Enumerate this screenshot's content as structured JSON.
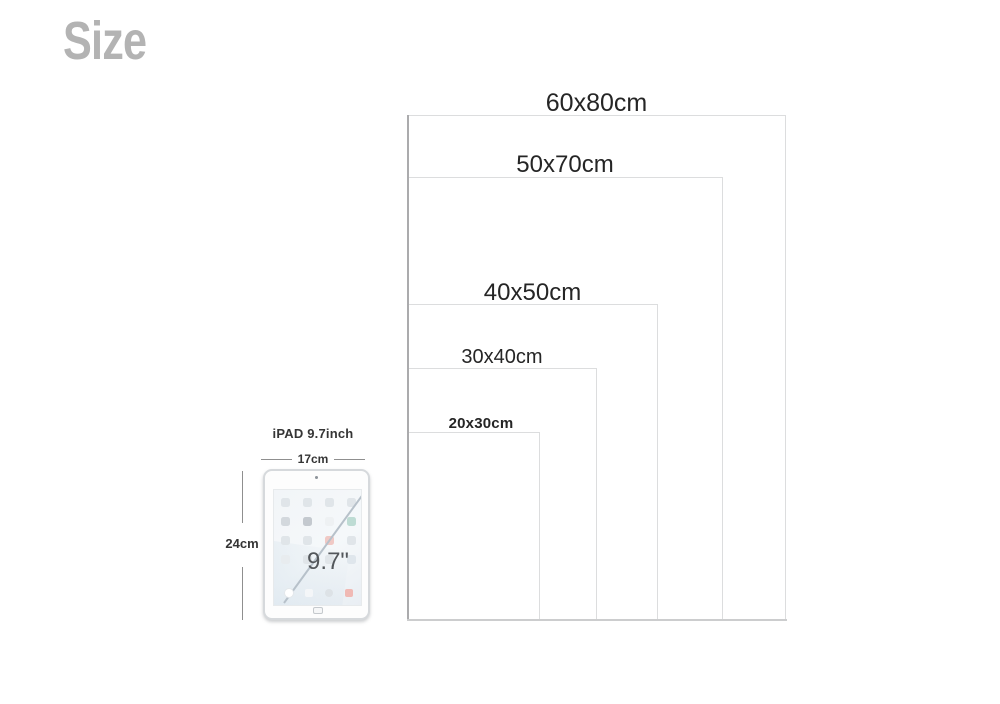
{
  "title": "Size",
  "sizes": [
    {
      "label": "60x80cm",
      "width_cm": 60,
      "height_cm": 80
    },
    {
      "label": "50x70cm",
      "width_cm": 50,
      "height_cm": 70
    },
    {
      "label": "40x50cm",
      "width_cm": 40,
      "height_cm": 50
    },
    {
      "label": "30x40cm",
      "width_cm": 30,
      "height_cm": 40
    },
    {
      "label": "20x30cm",
      "width_cm": 20,
      "height_cm": 30
    }
  ],
  "ipad": {
    "name_label": "iPAD 9.7inch",
    "width_label": "17cm",
    "height_label": "24cm",
    "diagonal_label": "9.7\""
  },
  "colors": {
    "heading_gray": "#b3b3b3",
    "label_text": "#252525",
    "rect_border": "#dcddde",
    "shared_edge": "#ababad",
    "dimension_line": "#8f8f8f",
    "diagonal_line": "#b7c1ca",
    "ipad_border": "#d6d9dc"
  }
}
